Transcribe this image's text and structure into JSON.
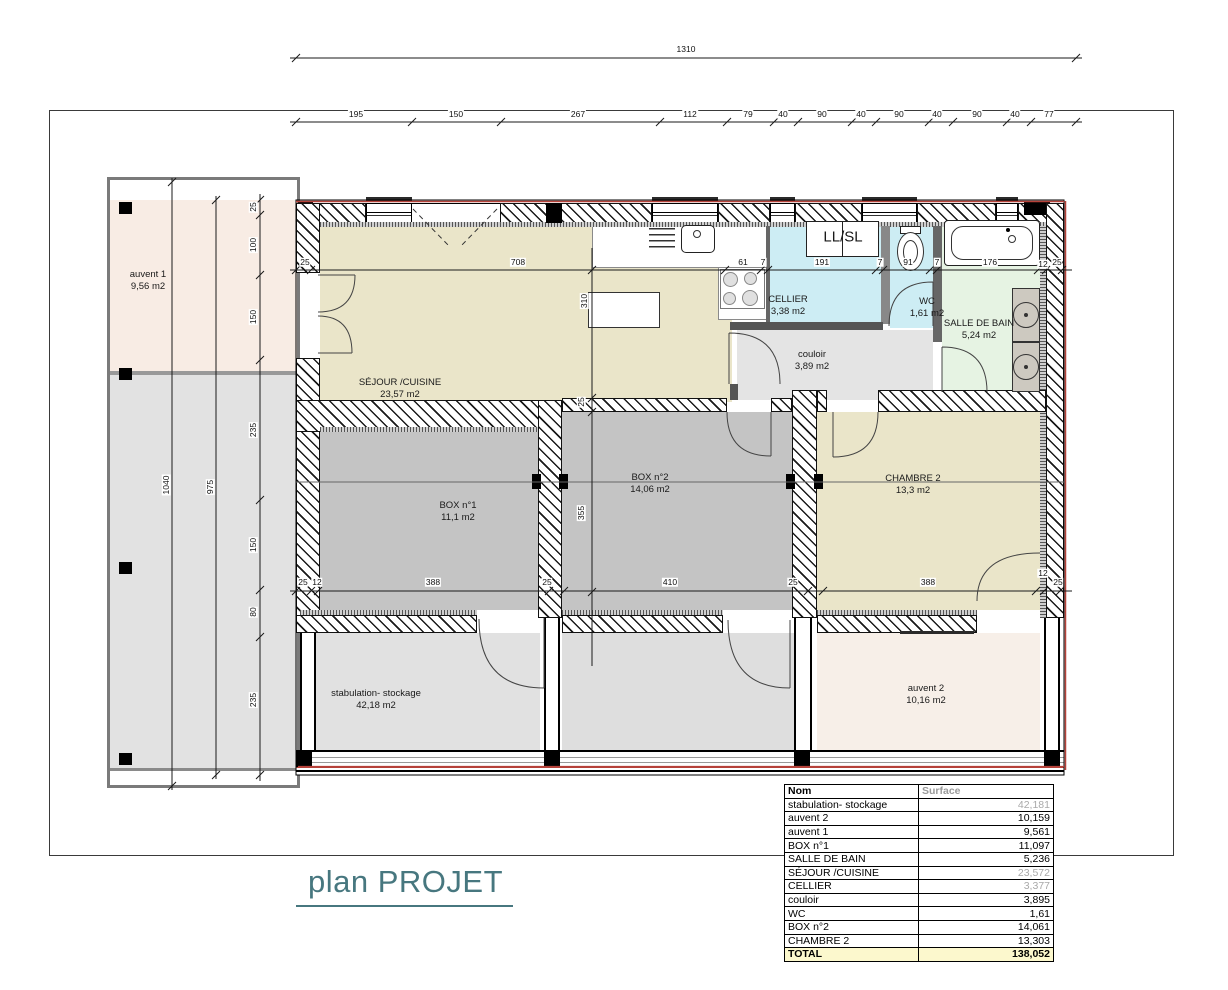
{
  "title": "plan PROJET",
  "dims": {
    "total_top": "1310",
    "top": [
      "195",
      "150",
      "267",
      "112",
      "79",
      "40",
      "90",
      "40",
      "90",
      "40",
      "90",
      "40",
      "77"
    ],
    "left": [
      "25",
      "100",
      "150",
      "235",
      "150",
      "80",
      "235"
    ],
    "height_outer": "1040",
    "height_inner": "975",
    "mid": [
      "25",
      "708",
      "61",
      "7",
      "191",
      "7",
      "91",
      "7",
      "176",
      "12",
      "25"
    ],
    "vert": [
      "310",
      "25",
      "355"
    ],
    "bottom": [
      "25",
      "12",
      "388",
      "25",
      "410",
      "25",
      "388",
      "12",
      "25"
    ]
  },
  "rooms": {
    "auvent1": {
      "name": "auvent 1",
      "area": "9,56 m2"
    },
    "sejour": {
      "name": "SÉJOUR /CUISINE",
      "area": "23,57 m2"
    },
    "cellier": {
      "name": "CELLIER",
      "area": "3,38 m2"
    },
    "wc": {
      "name": "WC",
      "area": "1,61 m2"
    },
    "sdb": {
      "name": "SALLE DE BAIN",
      "area": "5,24 m2"
    },
    "couloir": {
      "name": "couloir",
      "area": "3,89 m2"
    },
    "box1": {
      "name": "BOX n°1",
      "area": "11,1 m2"
    },
    "box2": {
      "name": "BOX n°2",
      "area": "14,06 m2"
    },
    "chambre2": {
      "name": "CHAMBRE 2",
      "area": "13,3 m2"
    },
    "stabulation": {
      "name": "stabulation- stockage",
      "area": "42,18 m2"
    },
    "auvent2": {
      "name": "auvent 2",
      "area": "10,16 m2"
    }
  },
  "fixtures": {
    "laundry": "LL/SL"
  },
  "table": {
    "headers": [
      "Nom",
      "Surface"
    ],
    "rows": [
      {
        "name": "stabulation- stockage",
        "value": "42,181",
        "muted": true
      },
      {
        "name": "auvent 2",
        "value": "10,159",
        "muted": false
      },
      {
        "name": "auvent 1",
        "value": "9,561",
        "muted": false
      },
      {
        "name": "BOX n°1",
        "value": "11,097",
        "muted": false
      },
      {
        "name": "SALLE DE BAIN",
        "value": "5,236",
        "muted": false
      },
      {
        "name": "SÉJOUR /CUISINE",
        "value": "23,572",
        "muted": true
      },
      {
        "name": "CELLIER",
        "value": "3,377",
        "muted": true
      },
      {
        "name": "couloir",
        "value": "3,895",
        "muted": false
      },
      {
        "name": "WC",
        "value": "1,61",
        "muted": false
      },
      {
        "name": "BOX n°2",
        "value": "14,061",
        "muted": false
      },
      {
        "name": "CHAMBRE 2",
        "value": "13,303",
        "muted": false
      }
    ],
    "total": {
      "name": "TOTAL",
      "value": "138,052"
    }
  },
  "colors": {
    "accent_red": "#b6423a",
    "title_teal": "#47777f",
    "beige": "#eae5c9",
    "cyan": "#cdedf4",
    "green": "#e6f3e3",
    "pink": "#f8ece4",
    "box_gray": "#c4c4c4",
    "total_row_bg": "#fcf8cd"
  }
}
